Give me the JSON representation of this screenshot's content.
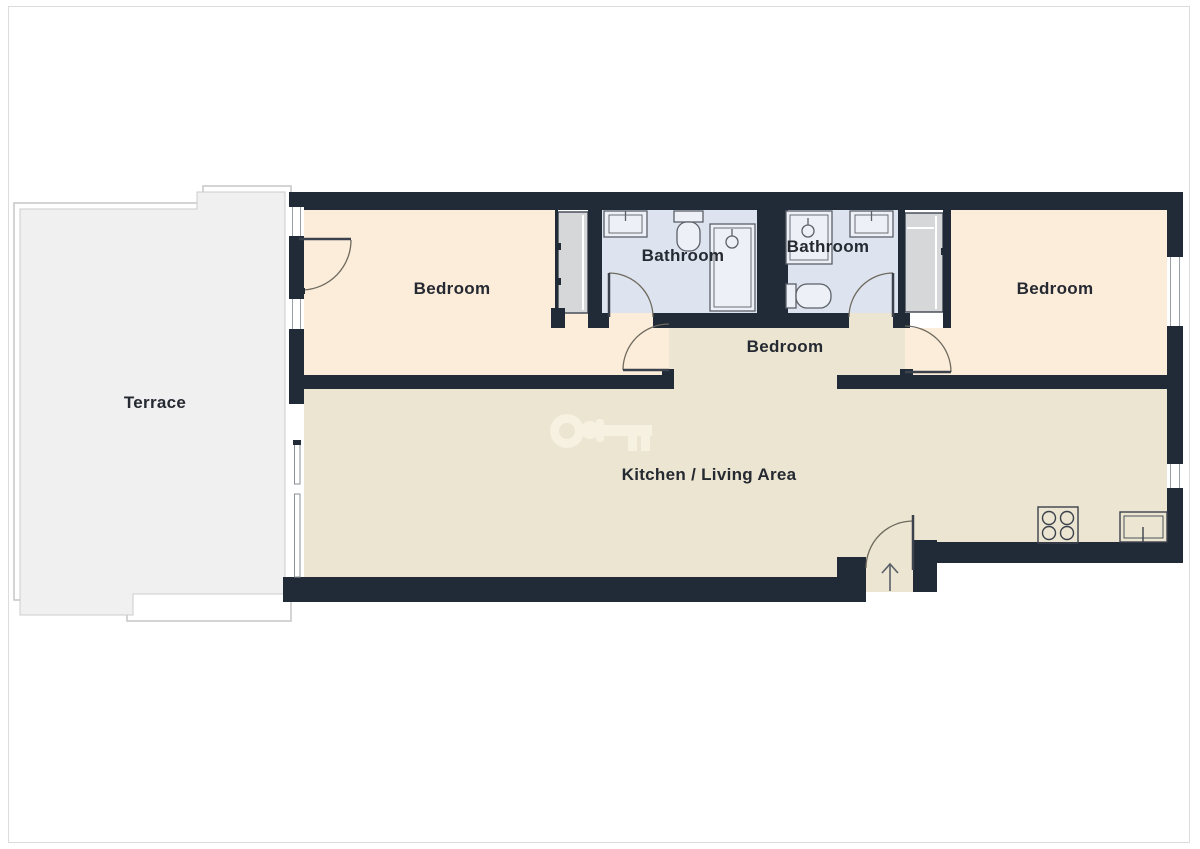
{
  "floorplan": {
    "title": "Apartment floor plan",
    "rooms": {
      "terrace": {
        "label": "Terrace"
      },
      "bedroom_left": {
        "label": "Bedroom"
      },
      "bathroom_left": {
        "label": "Bathroom"
      },
      "bathroom_right": {
        "label": "Bathroom"
      },
      "bedroom_middle": {
        "label": "Bedroom"
      },
      "bedroom_right": {
        "label": "Bedroom"
      },
      "kitchen_living": {
        "label": "Kitchen / Living Area"
      }
    },
    "fixtures": {
      "bathroom_left": [
        "sink",
        "toilet",
        "shower"
      ],
      "bathroom_right": [
        "shower",
        "sink",
        "toilet"
      ],
      "kitchen": [
        "stove",
        "sink"
      ],
      "storage": [
        "closet-left",
        "closet-right"
      ]
    },
    "icons": [
      "key-watermark-icon",
      "entrance-arrow-icon"
    ],
    "colors": {
      "wall": "#212a37",
      "bedroom_fill": "#fcecda",
      "kitchen_fill": "#ebe5d1",
      "bathroom_fill": "#dee4ef",
      "closet_fill": "#d6d7d9",
      "terrace_fill": "#f0f0f1",
      "door_arc": "#6e6a5e",
      "door_leaf": "#3c424d",
      "fixture_line": "#5b6069",
      "fixture_fill": "#edf0f6",
      "label_color": "#252931",
      "watermark": "#f8f2e2"
    }
  }
}
